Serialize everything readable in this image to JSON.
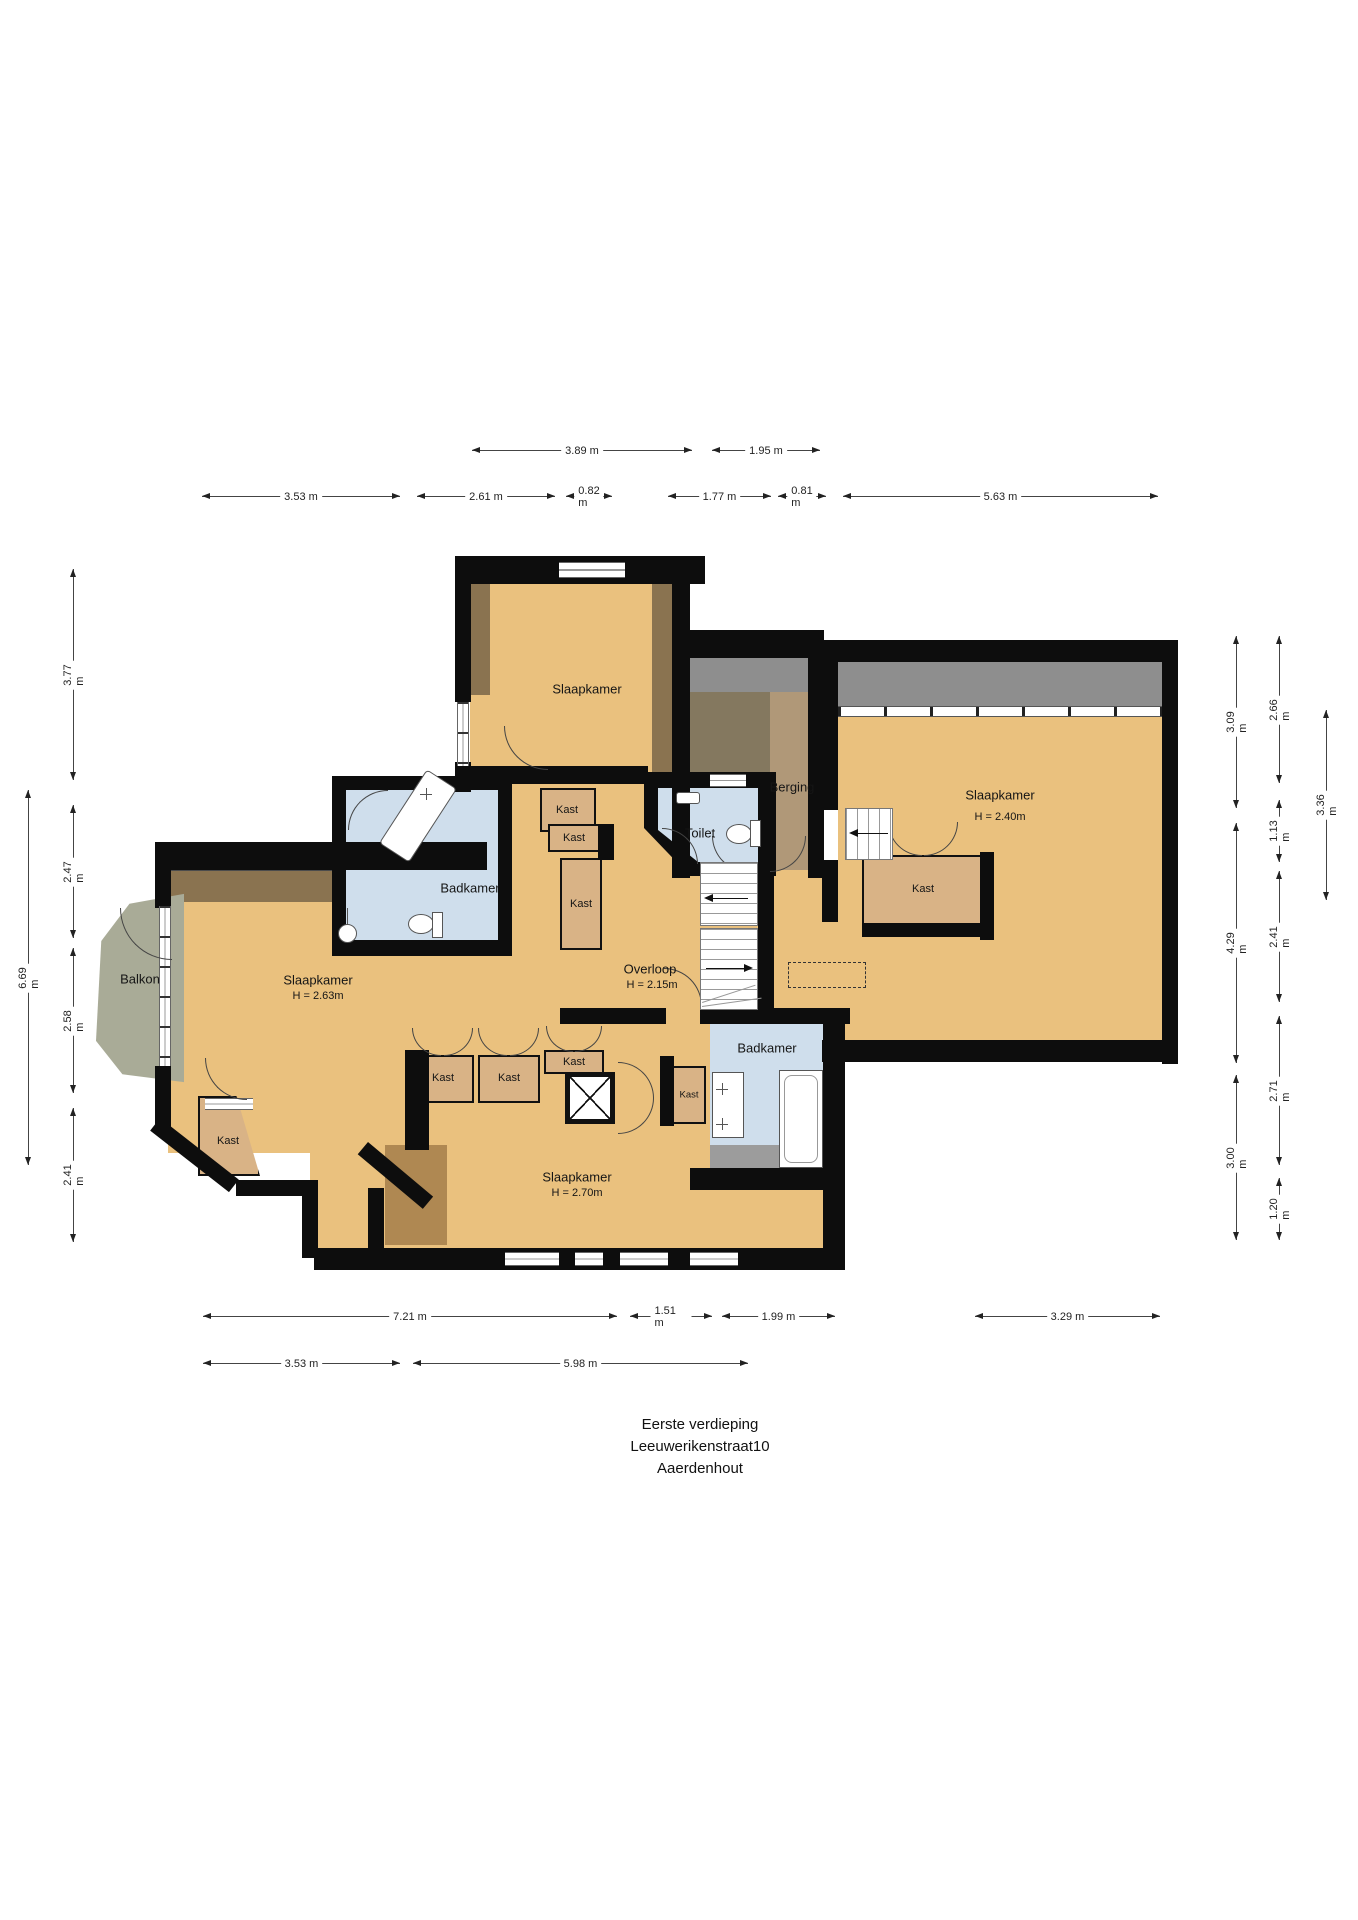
{
  "floorplan": {
    "title": [
      "Eerste verdieping",
      "Leeuwerikenstraat10",
      "Aaerdenhout"
    ],
    "rooms": {
      "slaapkamer_top": {
        "label": "Slaapkamer"
      },
      "slaapkamer_right": {
        "label": "Slaapkamer",
        "height": "H = 2.40m"
      },
      "slaapkamer_left": {
        "label": "Slaapkamer",
        "height": "H = 2.63m"
      },
      "slaapkamer_bottom": {
        "label": "Slaapkamer",
        "height": "H = 2.70m"
      },
      "overloop": {
        "label": "Overloop",
        "height": "H = 2.15m"
      },
      "badkamer": {
        "label": "Badkamer"
      },
      "toilet": {
        "label": "Toilet"
      },
      "berging": {
        "label": "Berging"
      },
      "balkon": {
        "label": "Balkon"
      },
      "kast": {
        "label": "Kast"
      }
    },
    "dimensions": {
      "top_row1": [
        "3.89 m",
        "1.95 m"
      ],
      "top_row2": [
        "3.53 m",
        "2.61 m",
        "0.82 m",
        "1.77 m",
        "0.81 m",
        "5.63 m"
      ],
      "left_outer": [
        "6.69 m"
      ],
      "left_inner": [
        "3.77 m",
        "2.47 m",
        "2.58 m",
        "2.41 m"
      ],
      "right_col1": [
        "3.09 m",
        "4.29 m",
        "3.00 m"
      ],
      "right_col2": [
        "2.66 m",
        "1.13 m",
        "2.41 m",
        "2.71 m",
        "1.20 m"
      ],
      "right_col3": [
        "3.36 m"
      ],
      "bottom_row1": [
        "7.21 m",
        "1.51 m",
        "1.99 m",
        "3.29 m"
      ],
      "bottom_row2": [
        "3.53 m",
        "5.98 m"
      ]
    },
    "colors": {
      "floor": "#eac17e",
      "wet_room": "#cfdeec",
      "closet": "#d9b386",
      "wall": "#0d0d0d",
      "roof_gray": "#8e8e8e",
      "balcony": "#a9ab97",
      "wood_brown": "#8a7350",
      "storage_brown": "#ab9679"
    }
  }
}
